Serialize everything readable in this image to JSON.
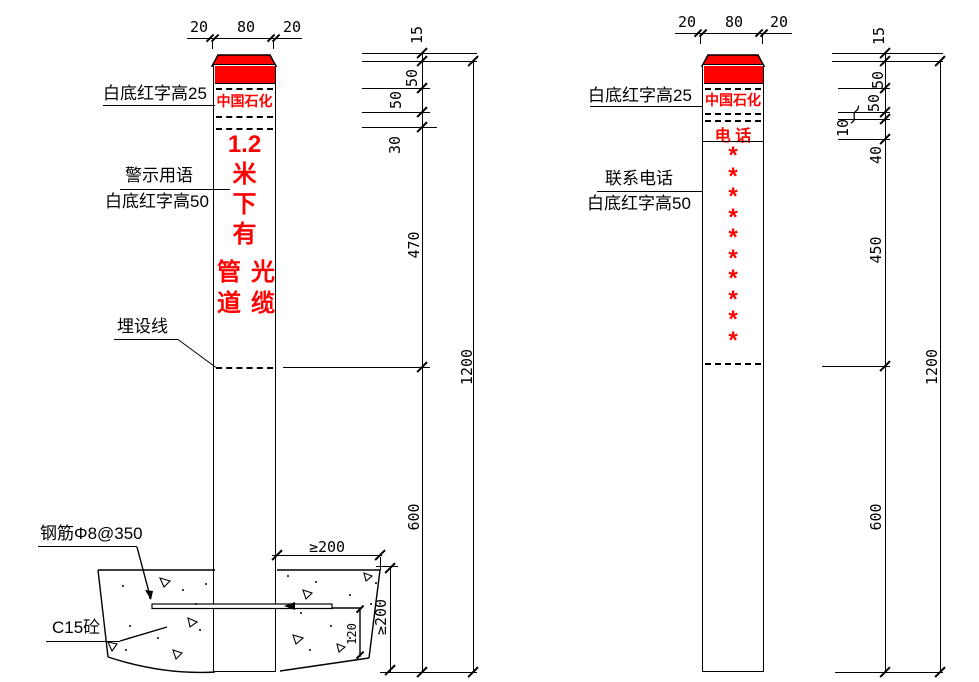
{
  "colors": {
    "red": "#ff0000",
    "line": "#000000",
    "background": "#ffffff"
  },
  "left": {
    "top_dims": [
      "20",
      "80",
      "20"
    ],
    "brand": "中国石化",
    "warning": [
      "1.2",
      "米",
      "下",
      "有"
    ],
    "warning_col1": [
      "管",
      "道"
    ],
    "warning_col2": [
      "光",
      "缆"
    ],
    "labels": {
      "cap": "白底红字高25",
      "warn_title": "警示用语",
      "warn_sub": "白底红字高50",
      "burial": "埋设线",
      "rebar": "钢筋Φ8@350",
      "concrete": "C15砼"
    },
    "dims": {
      "cap": "15",
      "band1": "50",
      "band2": "50",
      "gap": "30",
      "text_zone": "470",
      "buried": "600",
      "total": "1200"
    },
    "foundation": {
      "width": "≥200",
      "depth": "≥200",
      "inner": "120"
    }
  },
  "right": {
    "top_dims": [
      "20",
      "80",
      "20"
    ],
    "brand": "中国石化",
    "phone_title": "电 话",
    "asterisks": [
      "*",
      "*",
      "*",
      "*",
      "*",
      "*",
      "*",
      "*",
      "*",
      "*"
    ],
    "labels": {
      "cap": "白底红字高25",
      "contact_title": "联系电话",
      "contact_sub": "白底红字高50"
    },
    "dims": {
      "cap": "15",
      "band1": "50",
      "band2": "50",
      "gap": "10",
      "phone": "40",
      "text_zone": "450",
      "buried": "600",
      "total": "1200"
    }
  }
}
